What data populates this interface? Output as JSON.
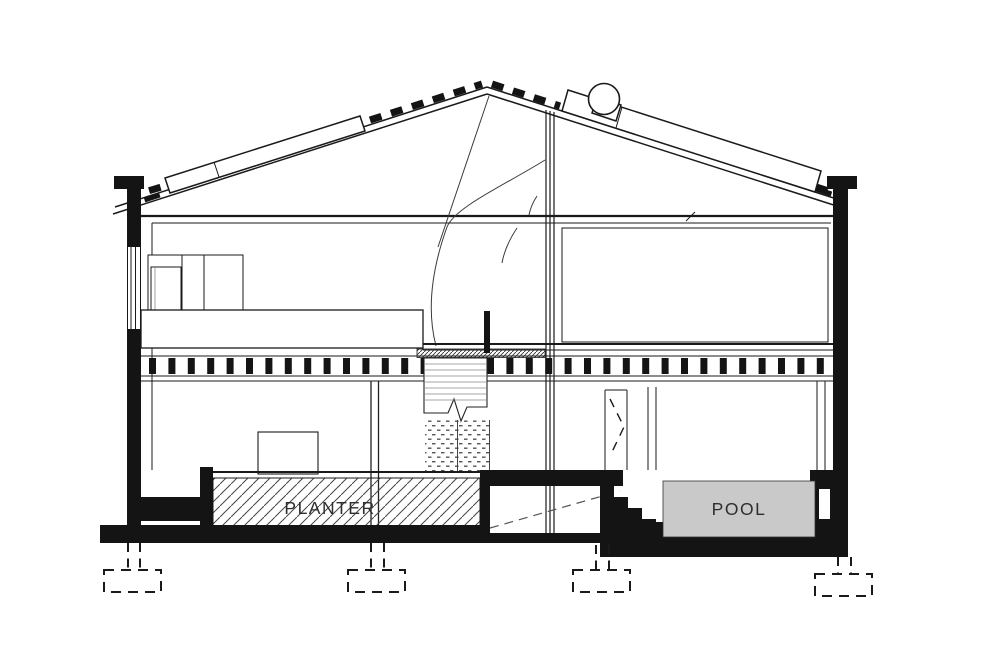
{
  "drawing": {
    "type": "architectural-cross-section",
    "labels": {
      "planter": "PLANTER",
      "pool": "POOL"
    },
    "colors": {
      "line": "#1a1a1a",
      "pool_fill": "#c9c9c9",
      "hatch": "#444444",
      "background": "#ffffff"
    }
  }
}
